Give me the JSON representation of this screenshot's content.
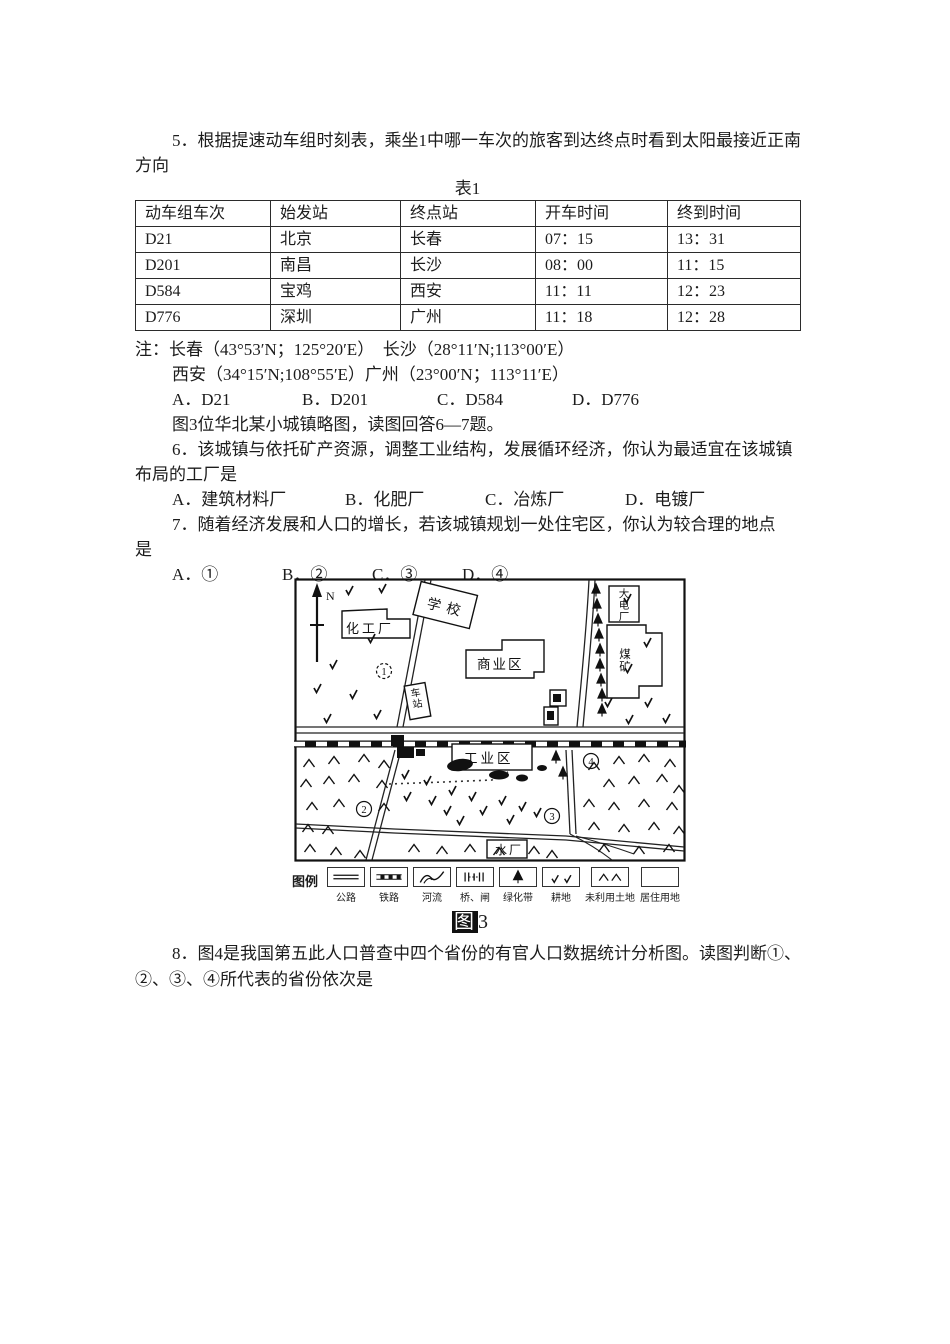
{
  "document": {
    "q5": {
      "line1": "5．根据提速动车组时刻表，乘坐1中哪一车次的旅客到达终点时看到太阳最接近正南",
      "line2": "方向"
    },
    "table1": {
      "caption": "表1",
      "headers": [
        "动车组车次",
        "始发站",
        "终点站",
        "开车时间",
        "终到时间"
      ],
      "rows": [
        [
          "D21",
          "北京",
          "长春",
          "07：15",
          "13：31"
        ],
        [
          "D201",
          "南昌",
          "长沙",
          "08：00",
          "11：15"
        ],
        [
          "D584",
          "宝鸡",
          "西安",
          "11：11",
          "12：23"
        ],
        [
          "D776",
          "深圳",
          "广州",
          "11：18",
          "12：28"
        ]
      ]
    },
    "notes": {
      "line1": "注：长春（43°53′N；125°20′E）　长沙（28°11′N;113°00′E）",
      "line2": "西安（34°15′N;108°55′E）广州（23°00′N；113°11′E）"
    },
    "options_q5": [
      "A．D21",
      "B．D201",
      "C．D584",
      "D．D776"
    ],
    "fig3_intro": "图3位华北某小城镇略图，读图回答6—7题。",
    "q6": {
      "line1": "6．该城镇与依托矿产资源，调整工业结构，发展循环经济，你认为最适宜在该城镇",
      "line2": "布局的工厂是"
    },
    "options_q6": [
      "A．建筑材料厂",
      "B．化肥厂",
      "C．冶炼厂",
      "D．电镀厂"
    ],
    "q7": {
      "line1": "7．随着经济发展和人口的增长，若该城镇规划一处住宅区，你认为较合理的地点",
      "line2": "是"
    },
    "options_q7": [
      "A．①",
      "B．②",
      "C．③",
      "D．④"
    ],
    "q8": {
      "line1": "8．图4是我国第五此人口普查中四个省份的有官人口数据统计分析图。读图判断①、",
      "line2": "②、③、④所代表的省份依次是"
    }
  },
  "map": {
    "north": "N",
    "labels": {
      "chemical_plant": "化工厂",
      "school": "学校",
      "commercial": "商业区",
      "station": "车站",
      "power_plant": "大电厂",
      "coal_mine": "煤矿",
      "industrial": "工业区",
      "water_plant": "水厂"
    },
    "circles": [
      "1",
      "2",
      "3",
      "4"
    ],
    "legend": {
      "title": "图例",
      "items": [
        "公路",
        "铁路",
        "河流",
        "桥、闸",
        "绿化带",
        "耕地",
        "未利用土地",
        "居住用地"
      ]
    },
    "caption": {
      "prefix": "图",
      "number": "3"
    }
  },
  "colors": {
    "ink": "#1c1c1c",
    "paper": "#ffffff"
  }
}
